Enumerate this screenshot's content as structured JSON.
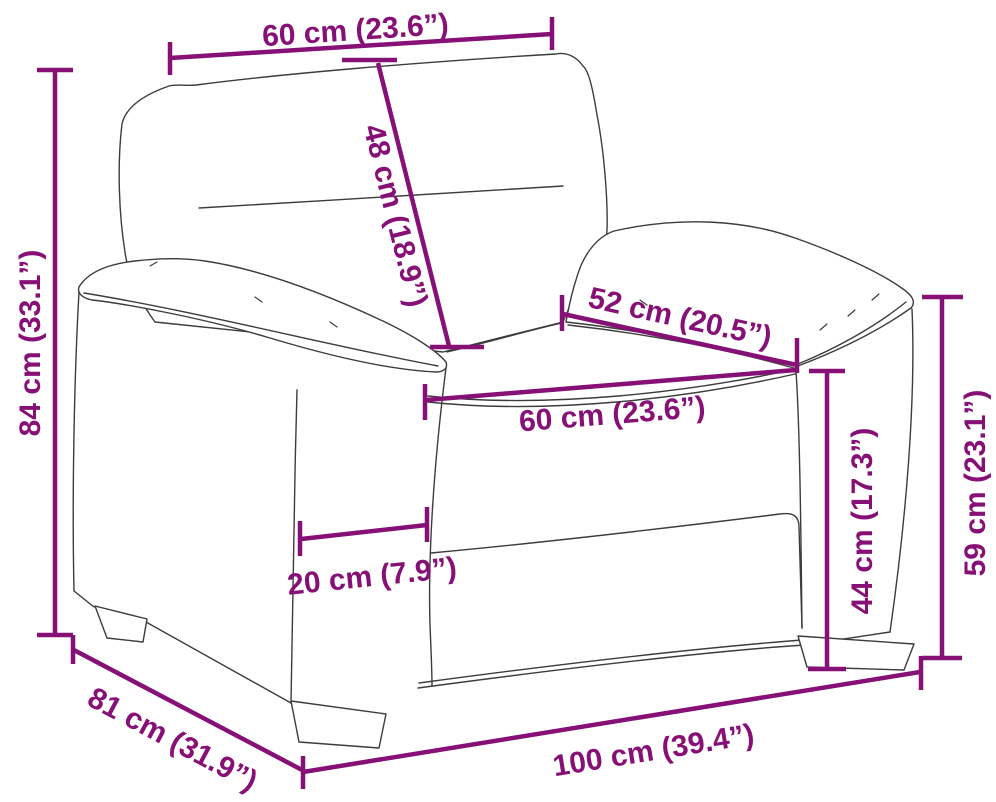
{
  "image": {
    "kind": "product-dimension-diagram",
    "product": "armchair",
    "width_px": 996,
    "height_px": 802,
    "background": "#ffffff"
  },
  "colors": {
    "dimension_annotation": "#871077",
    "product_outline": "#3c3c3c"
  },
  "dimensions": {
    "backrest_width": {
      "label": "60 cm (23.6”)"
    },
    "backrest_height": {
      "label": "48 cm (18.9”)"
    },
    "armrest_depth": {
      "label": "52 cm (20.5”)"
    },
    "seat_width": {
      "label": "60 cm (23.6”)"
    },
    "total_height": {
      "label": "84 cm (33.1”)"
    },
    "armrest_width": {
      "label": "20 cm (7.9”)"
    },
    "seat_height": {
      "label": "44 cm (17.3”)"
    },
    "armrest_height": {
      "label": "59 cm (23.1”)"
    },
    "depth": {
      "label": "81 cm (31.9”)"
    },
    "total_width": {
      "label": "100 cm (39.4”)"
    }
  }
}
